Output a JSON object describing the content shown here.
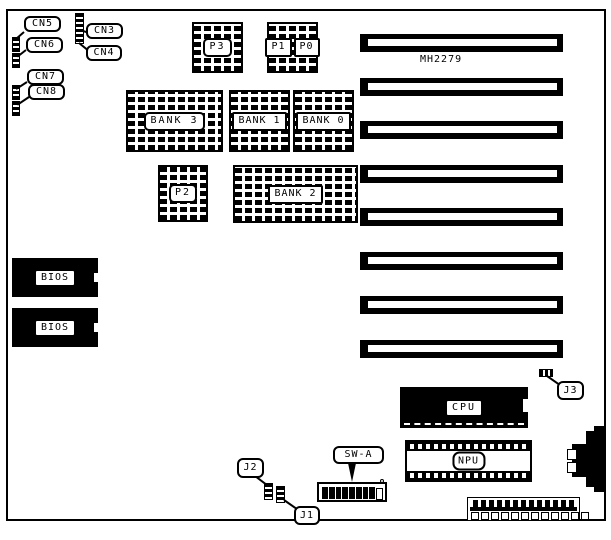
{
  "board": {
    "model": "MH2279",
    "slot_count": 8
  },
  "colors": {
    "ink": "#000000",
    "paper": "#ffffff"
  },
  "labels": {
    "cn3": "CN3",
    "cn4": "CN4",
    "cn5": "CN5",
    "cn6": "CN6",
    "cn7": "CN7",
    "cn8": "CN8",
    "p0": "P0",
    "p1": "P1",
    "p2": "P2",
    "p3": "P3",
    "bank0": "BANK 0",
    "bank1": "BANK 1",
    "bank2": "BANK 2",
    "bank3": "BANK 3",
    "bios_top": "BIOS",
    "bios_bottom": "BIOS",
    "cpu": "CPU",
    "npu": "NPU",
    "j1": "J1",
    "j2": "J2",
    "j3": "J3",
    "sw_a": "SW-A"
  }
}
